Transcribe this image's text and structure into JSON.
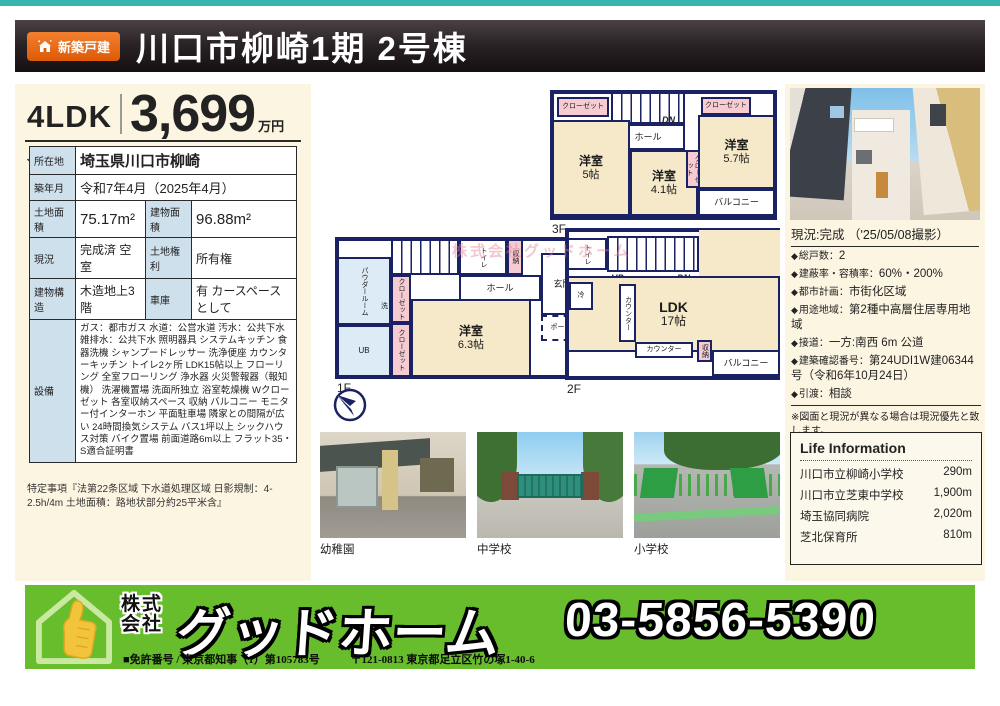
{
  "header": {
    "badge": "新築戸建",
    "title": "川口市柳崎1期 2号棟"
  },
  "price": {
    "layout": "4LDK",
    "amount": "3,699",
    "unit": "万円",
    "rail_line": "JR武蔵野線",
    "station": "「東浦和」駅 徒歩15分",
    "distance": "(1,200m)"
  },
  "details": {
    "rows": [
      {
        "label": "所在地",
        "value": "埼玉県川口市柳崎"
      },
      {
        "label": "築年月",
        "value": "令和7年4月（2025年4月）"
      },
      {
        "label": "土地面積",
        "value": "75.17m²",
        "label2": "建物面積",
        "value2": "96.88m²"
      },
      {
        "label": "現況",
        "value": "完成済 空室",
        "label2": "土地権利",
        "value2": "所有権"
      },
      {
        "label": "建物構造",
        "value": "木造地上3階",
        "label2": "車庫",
        "value2": "有 カースペースとして"
      },
      {
        "label": "設備",
        "value": "ガス：都市ガス 水道：公営水道 汚水：公共下水 雑排水：公共下水 照明器具 システムキッチン 食器洗機 シャンプードレッサー 洗浄便座 カウンターキッチン トイレ2ヶ所 LDK15帖以上 フローリング 全室フローリング 浄水器 火災警報器（報知機） 洗濯機置場 洗面所独立 浴室乾燥機 Wクローゼット 各室収納スペース 収納 バルコニー モニター付インターホン 平面駐車場 隣家との間隔が広い 24時間換気システム バス1坪以上 シックハウス対策 バイク置場 前面道路6m以上 フラット35・S適合証明書"
      }
    ],
    "special_note": "特定事項『法第22条区域 下水道処理区域 日影規制：4-2.5h/4m 土地面積：路地状部分約25平米含』"
  },
  "floorplans": {
    "watermark": "株式会社グッドホーム",
    "f1": {
      "label": "1F",
      "powder_room": "パウダールーム",
      "wash": "洗",
      "ub": "UB",
      "up": "UP",
      "toilet": "トイレ",
      "storage": "収納",
      "hall": "ホール",
      "entrance": "玄関",
      "closet1": "クローゼット",
      "closet2": "クローゼット",
      "room": "洋室",
      "room_size": "6.3帖",
      "porch": "ポーチ"
    },
    "f2": {
      "label": "2F",
      "toilet": "トイレ",
      "up": "UP",
      "dn": "DN",
      "fridge": "冷",
      "counter_side": "カウンター",
      "counter_bottom": "カウンター",
      "ldk": "LDK",
      "ldk_size": "17帖",
      "storage": "収納",
      "balcony": "バルコニー"
    },
    "f3": {
      "label": "3F",
      "closet1": "クローゼット",
      "closet2": "クローゼット",
      "closet3": "クローゼット",
      "hall": "ホール",
      "dn": "DN",
      "room1": "洋室",
      "room1_size": "5帖",
      "room2": "洋室",
      "room2_size": "4.1帖",
      "room3": "洋室",
      "room3_size": "5.7帖",
      "balcony": "バルコニー"
    }
  },
  "photo": {
    "caption": "現況:完成 （'25/05/08撮影）"
  },
  "notes": {
    "items": [
      {
        "label": "総戸数",
        "value": "2"
      },
      {
        "label": "建蔽率・容積率",
        "value": "60%・200%"
      },
      {
        "label": "都市計画",
        "value": "市街化区域"
      },
      {
        "label": "用途地域",
        "value": "第2種中高層住居専用地域"
      },
      {
        "label": "接道",
        "value": "一方:南西 6m 公道"
      },
      {
        "label": "建築確認番号",
        "value": "第24UDI1W建06344号（令和6年10月24日）"
      },
      {
        "label": "引渡",
        "value": "相談"
      }
    ],
    "disclaimer": "※図面と現況が異なる場合は現況優先と致します。",
    "property_id": "ID:0796575"
  },
  "life_info": {
    "title": "Life Information",
    "items": [
      {
        "name": "川口市立柳崎小学校",
        "distance": "290m"
      },
      {
        "name": "川口市立芝東中学校",
        "distance": "1,900m"
      },
      {
        "name": "埼玉協同病院",
        "distance": "2,020m"
      },
      {
        "name": "芝北保育所",
        "distance": "810m"
      }
    ]
  },
  "neighborhood": {
    "photos": [
      {
        "label": "幼稚園"
      },
      {
        "label": "中学校"
      },
      {
        "label": "小学校"
      }
    ]
  },
  "footer": {
    "company_prefix": "株式会社",
    "company_name": "グッドホーム",
    "phone": "03-5856-5390",
    "license": "■免許番号 / 東京都知事（1）第105783号",
    "address": "〒121-0813 東京都足立区竹の塚1-40-6"
  },
  "colors": {
    "accent_teal": "#35b5ac",
    "badge_orange": "#e8610d",
    "banner_green": "#68bd2c",
    "wall_navy": "#1b2263",
    "room_cream": "#f6e9c9",
    "table_label_blue": "#cfe0ed",
    "panel_cream": "#fcf5e2"
  }
}
